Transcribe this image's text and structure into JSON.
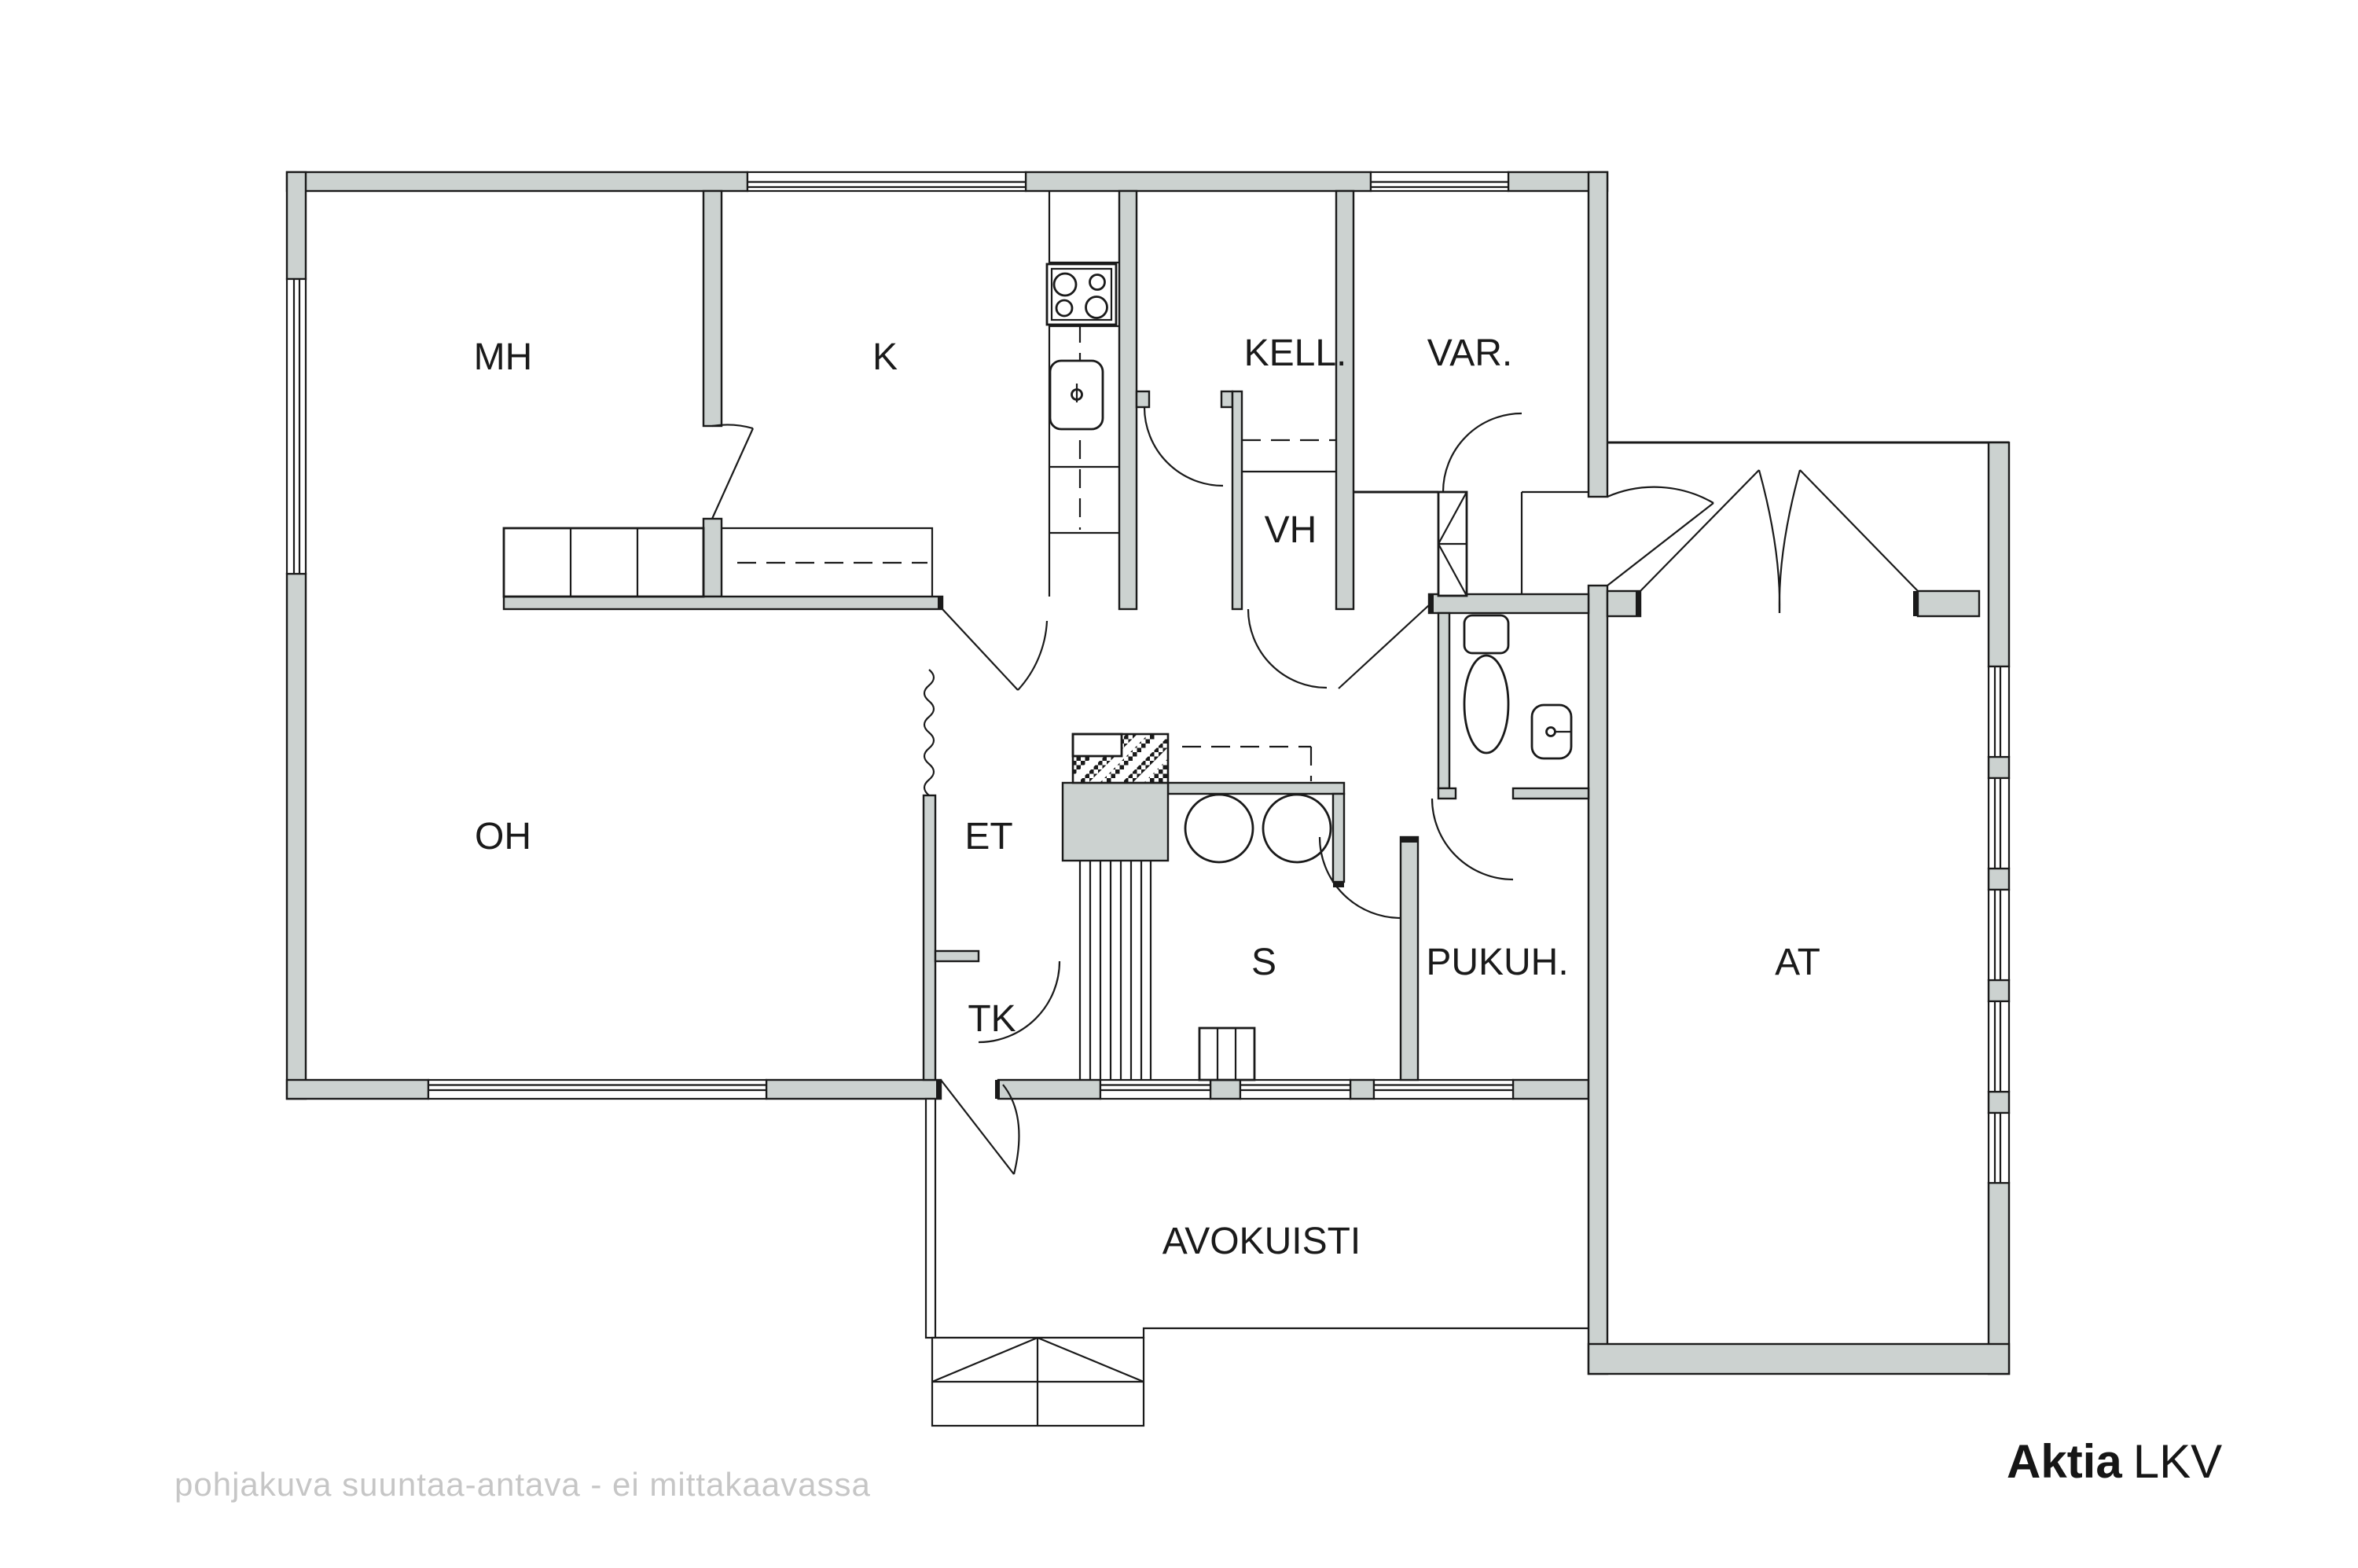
{
  "meta": {
    "kind": "floor-plan"
  },
  "colors": {
    "wall_fill": "#ccd2d0",
    "line": "#1a1a1a",
    "muted_text": "#c6c6c6",
    "brand_text": "#161616"
  },
  "rooms": {
    "mh": "MH",
    "k": "K",
    "kell": "KELL.",
    "var": "VAR.",
    "vh": "VH",
    "oh": "OH",
    "et": "ET",
    "tk": "TK",
    "s": "S",
    "pukuh": "PUKUH.",
    "at": "AT",
    "avokuisti": "AVOKUISTI"
  },
  "footer": {
    "disclaimer": "pohjakuva suuntaa-antava - ei mittakaavassa",
    "brand_bold": "Aktia",
    "brand_regular": "LKV"
  }
}
